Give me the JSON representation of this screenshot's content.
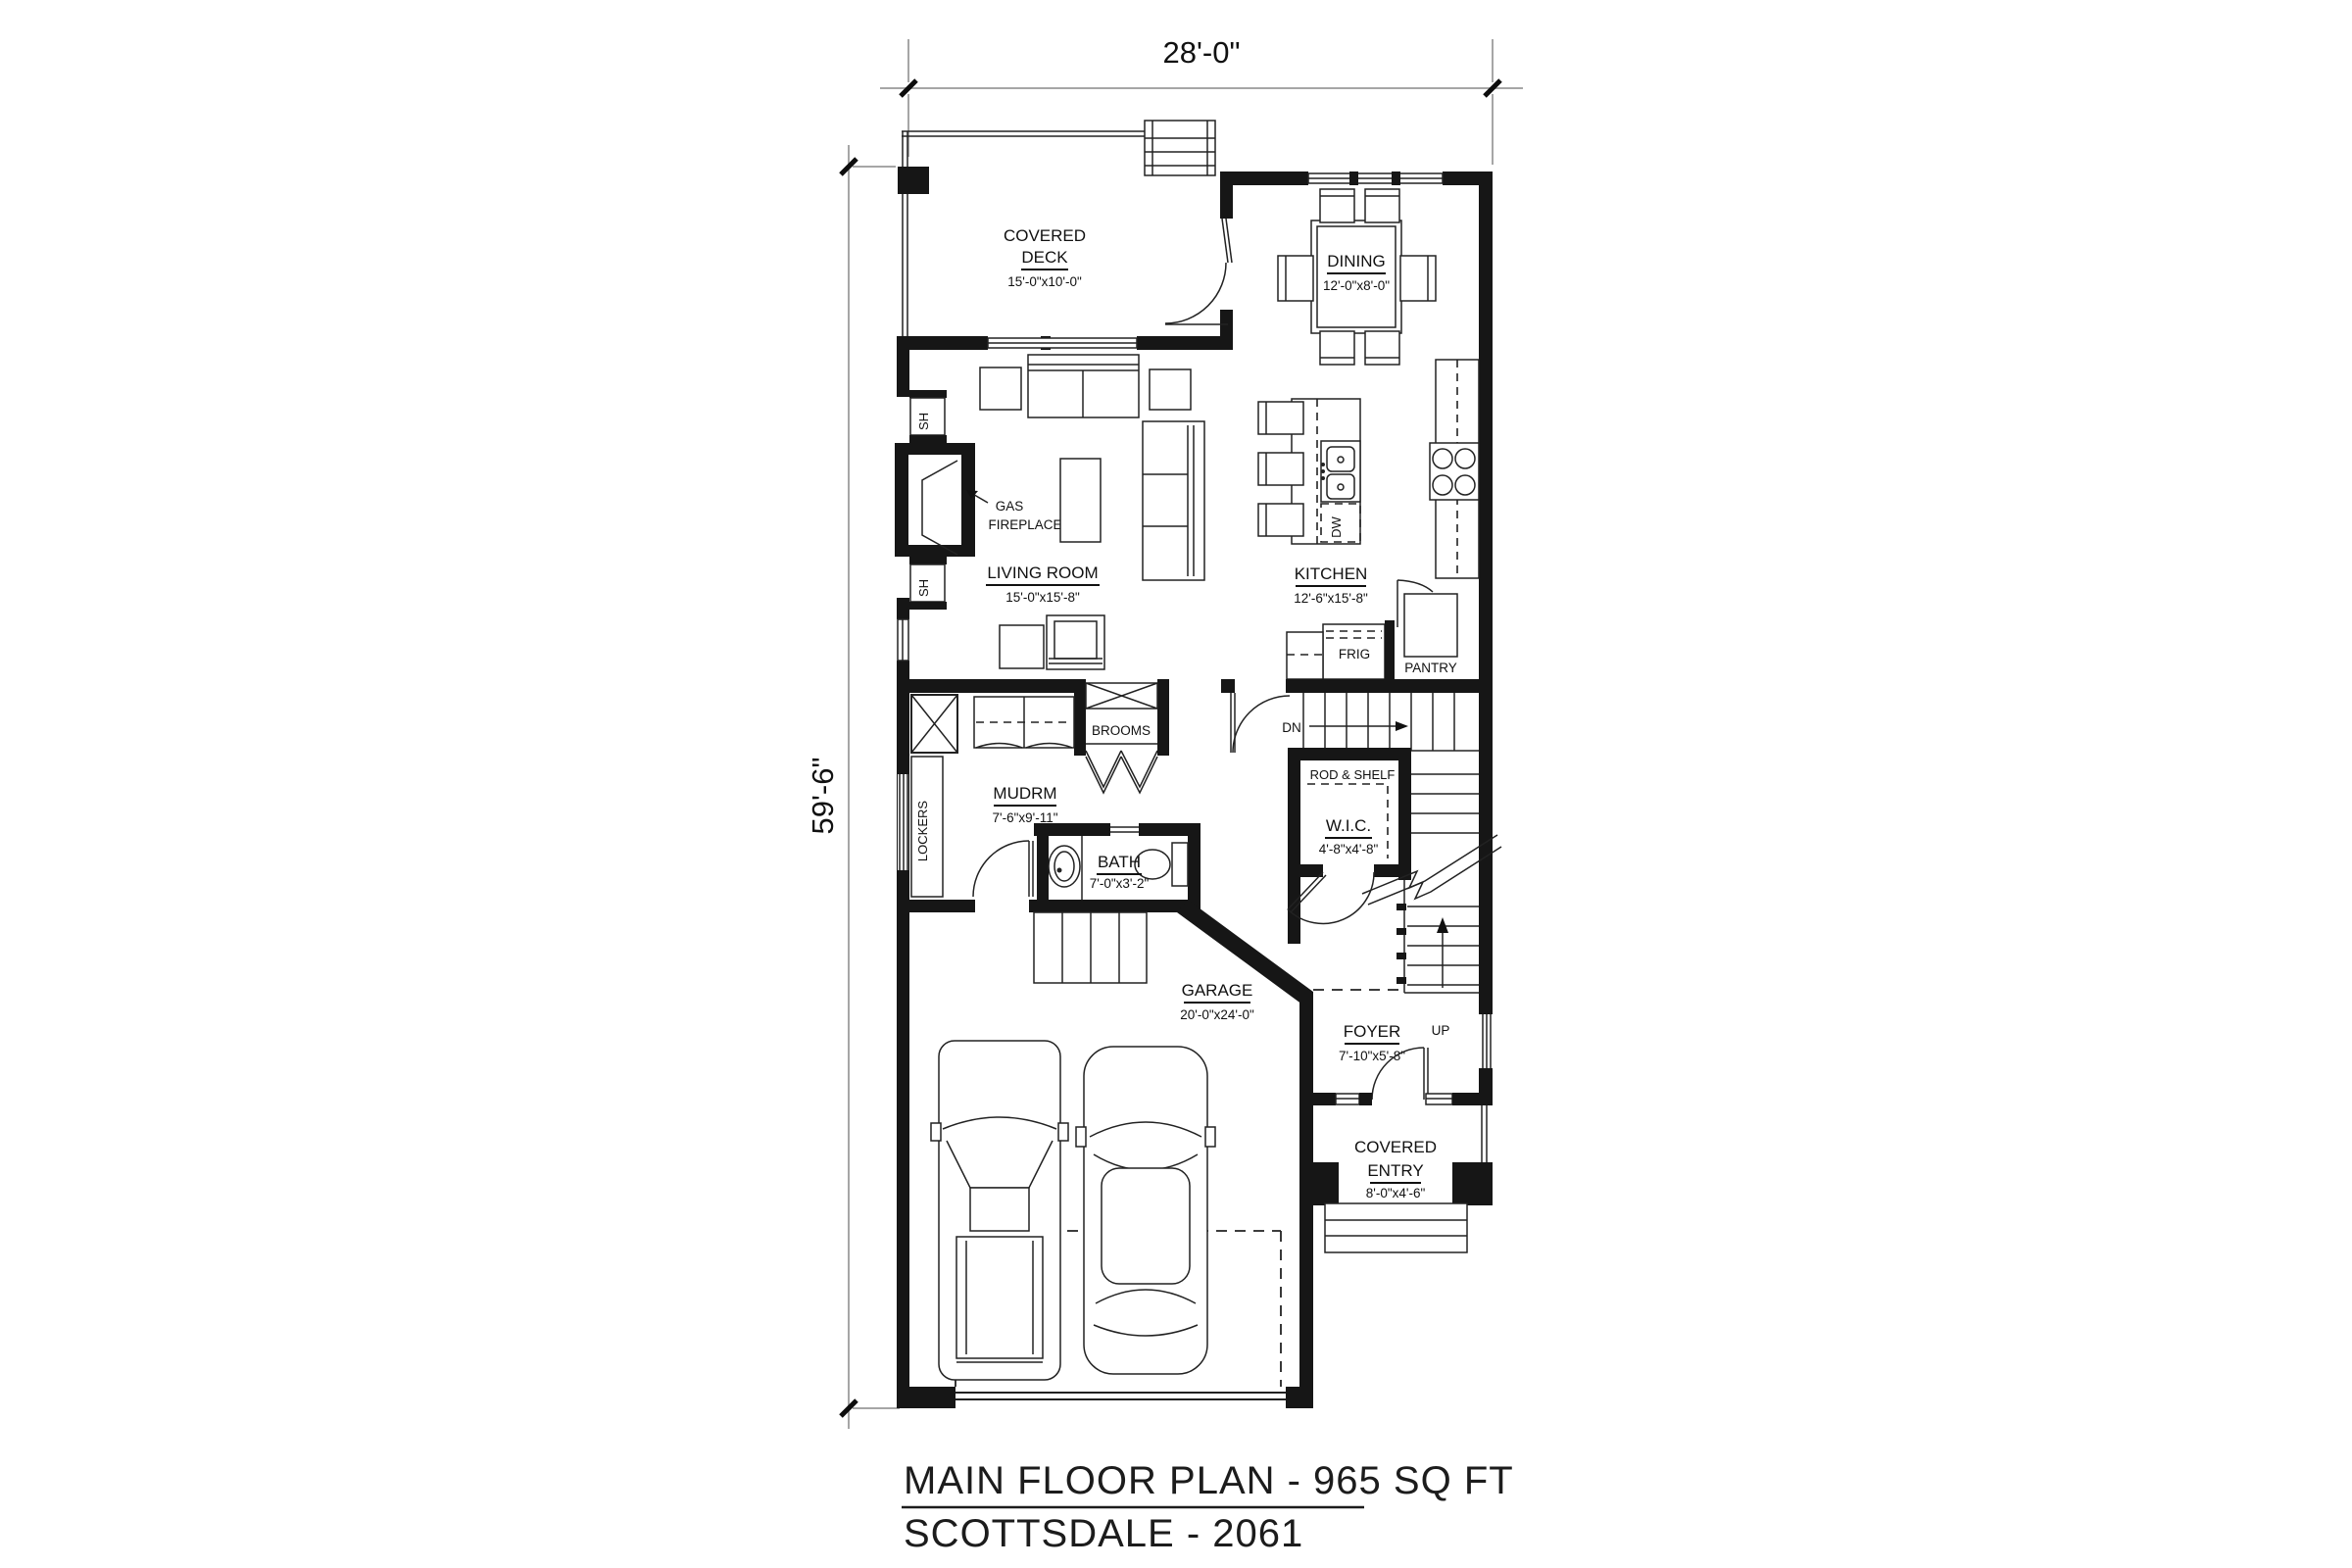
{
  "dimensions": {
    "width_label": "28'-0\"",
    "height_label": "59'-6\""
  },
  "rooms": {
    "covered_deck": {
      "name1": "COVERED",
      "name2": "DECK",
      "dims": "15'-0\"x10'-0\""
    },
    "dining": {
      "name": "DINING",
      "dims": "12'-0\"x8'-0\""
    },
    "living_room": {
      "name": "LIVING ROOM",
      "dims": "15'-0\"x15'-8\""
    },
    "kitchen": {
      "name": "KITCHEN",
      "dims": "12'-6\"x15'-8\""
    },
    "mudroom": {
      "name": "MUDRM",
      "dims": "7'-6\"x9'-11\""
    },
    "bath": {
      "name": "BATH",
      "dims": "7'-0\"x3'-2\""
    },
    "wic": {
      "name": "W.I.C.",
      "dims": "4'-8\"x4'-8\""
    },
    "foyer": {
      "name": "FOYER",
      "dims": "7'-10\"x5'-8\""
    },
    "garage": {
      "name": "GARAGE",
      "dims": "20'-0\"x24'-0\""
    },
    "covered_entry": {
      "name1": "COVERED",
      "name2": "ENTRY",
      "dims": "8'-0\"x4'-6\""
    }
  },
  "fixtures": {
    "gas_fireplace1": "GAS",
    "gas_fireplace2": "FIREPLACE",
    "shelf_top": "SH",
    "shelf_bottom": "SH",
    "lockers": "LOCKERS",
    "brooms": "BROOMS",
    "dishwasher": "DW",
    "fridge": "FRIG",
    "pantry": "PANTRY",
    "rod_shelf": "ROD & SHELF",
    "down": "DN",
    "up": "UP"
  },
  "title": {
    "line1": "MAIN FLOOR PLAN - 965 SQ FT",
    "line2": "SCOTTSDALE - 2061"
  }
}
